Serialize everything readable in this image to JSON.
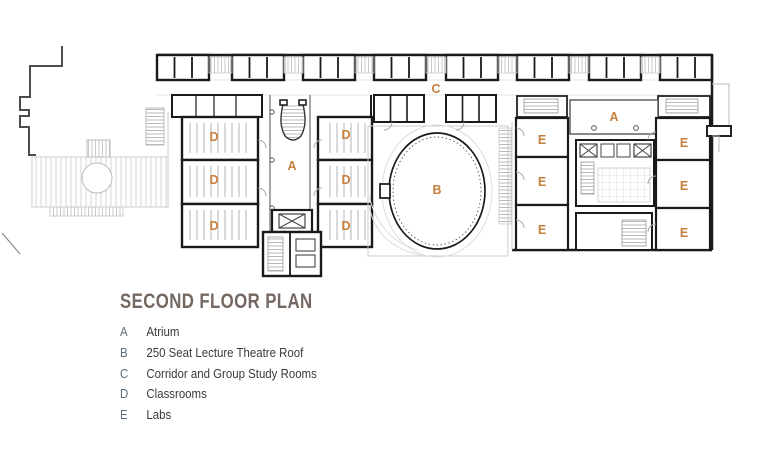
{
  "title": {
    "text": "SECOND FLOOR PLAN",
    "color": "#756862"
  },
  "legend": {
    "key_color": "#5b6d7c",
    "text_color": "#3a3a3a",
    "items": [
      {
        "key": "A",
        "label": "Atrium"
      },
      {
        "key": "B",
        "label": "250 Seat Lecture Theatre Roof"
      },
      {
        "key": "C",
        "label": "Corridor and Group Study Rooms"
      },
      {
        "key": "D",
        "label": "Classrooms"
      },
      {
        "key": "E",
        "label": "Labs"
      }
    ]
  },
  "plan": {
    "region_label_color": "#c77f3e",
    "labels": [
      {
        "room": "classroom",
        "text": "D"
      },
      {
        "room": "classroom",
        "text": "D"
      },
      {
        "room": "classroom",
        "text": "D"
      },
      {
        "room": "classroom",
        "text": "D"
      },
      {
        "room": "classroom",
        "text": "D"
      },
      {
        "room": "classroom",
        "text": "D"
      },
      {
        "room": "atrium",
        "text": "A"
      },
      {
        "room": "lecture-theatre-roof",
        "text": "B"
      },
      {
        "room": "corridor-group-study",
        "text": "C"
      },
      {
        "room": "atrium",
        "text": "A"
      },
      {
        "room": "lab",
        "text": "E"
      },
      {
        "room": "lab",
        "text": "E"
      },
      {
        "room": "lab",
        "text": "E"
      },
      {
        "room": "lab",
        "text": "E"
      },
      {
        "room": "lab",
        "text": "E"
      },
      {
        "room": "lab",
        "text": "E"
      }
    ]
  }
}
